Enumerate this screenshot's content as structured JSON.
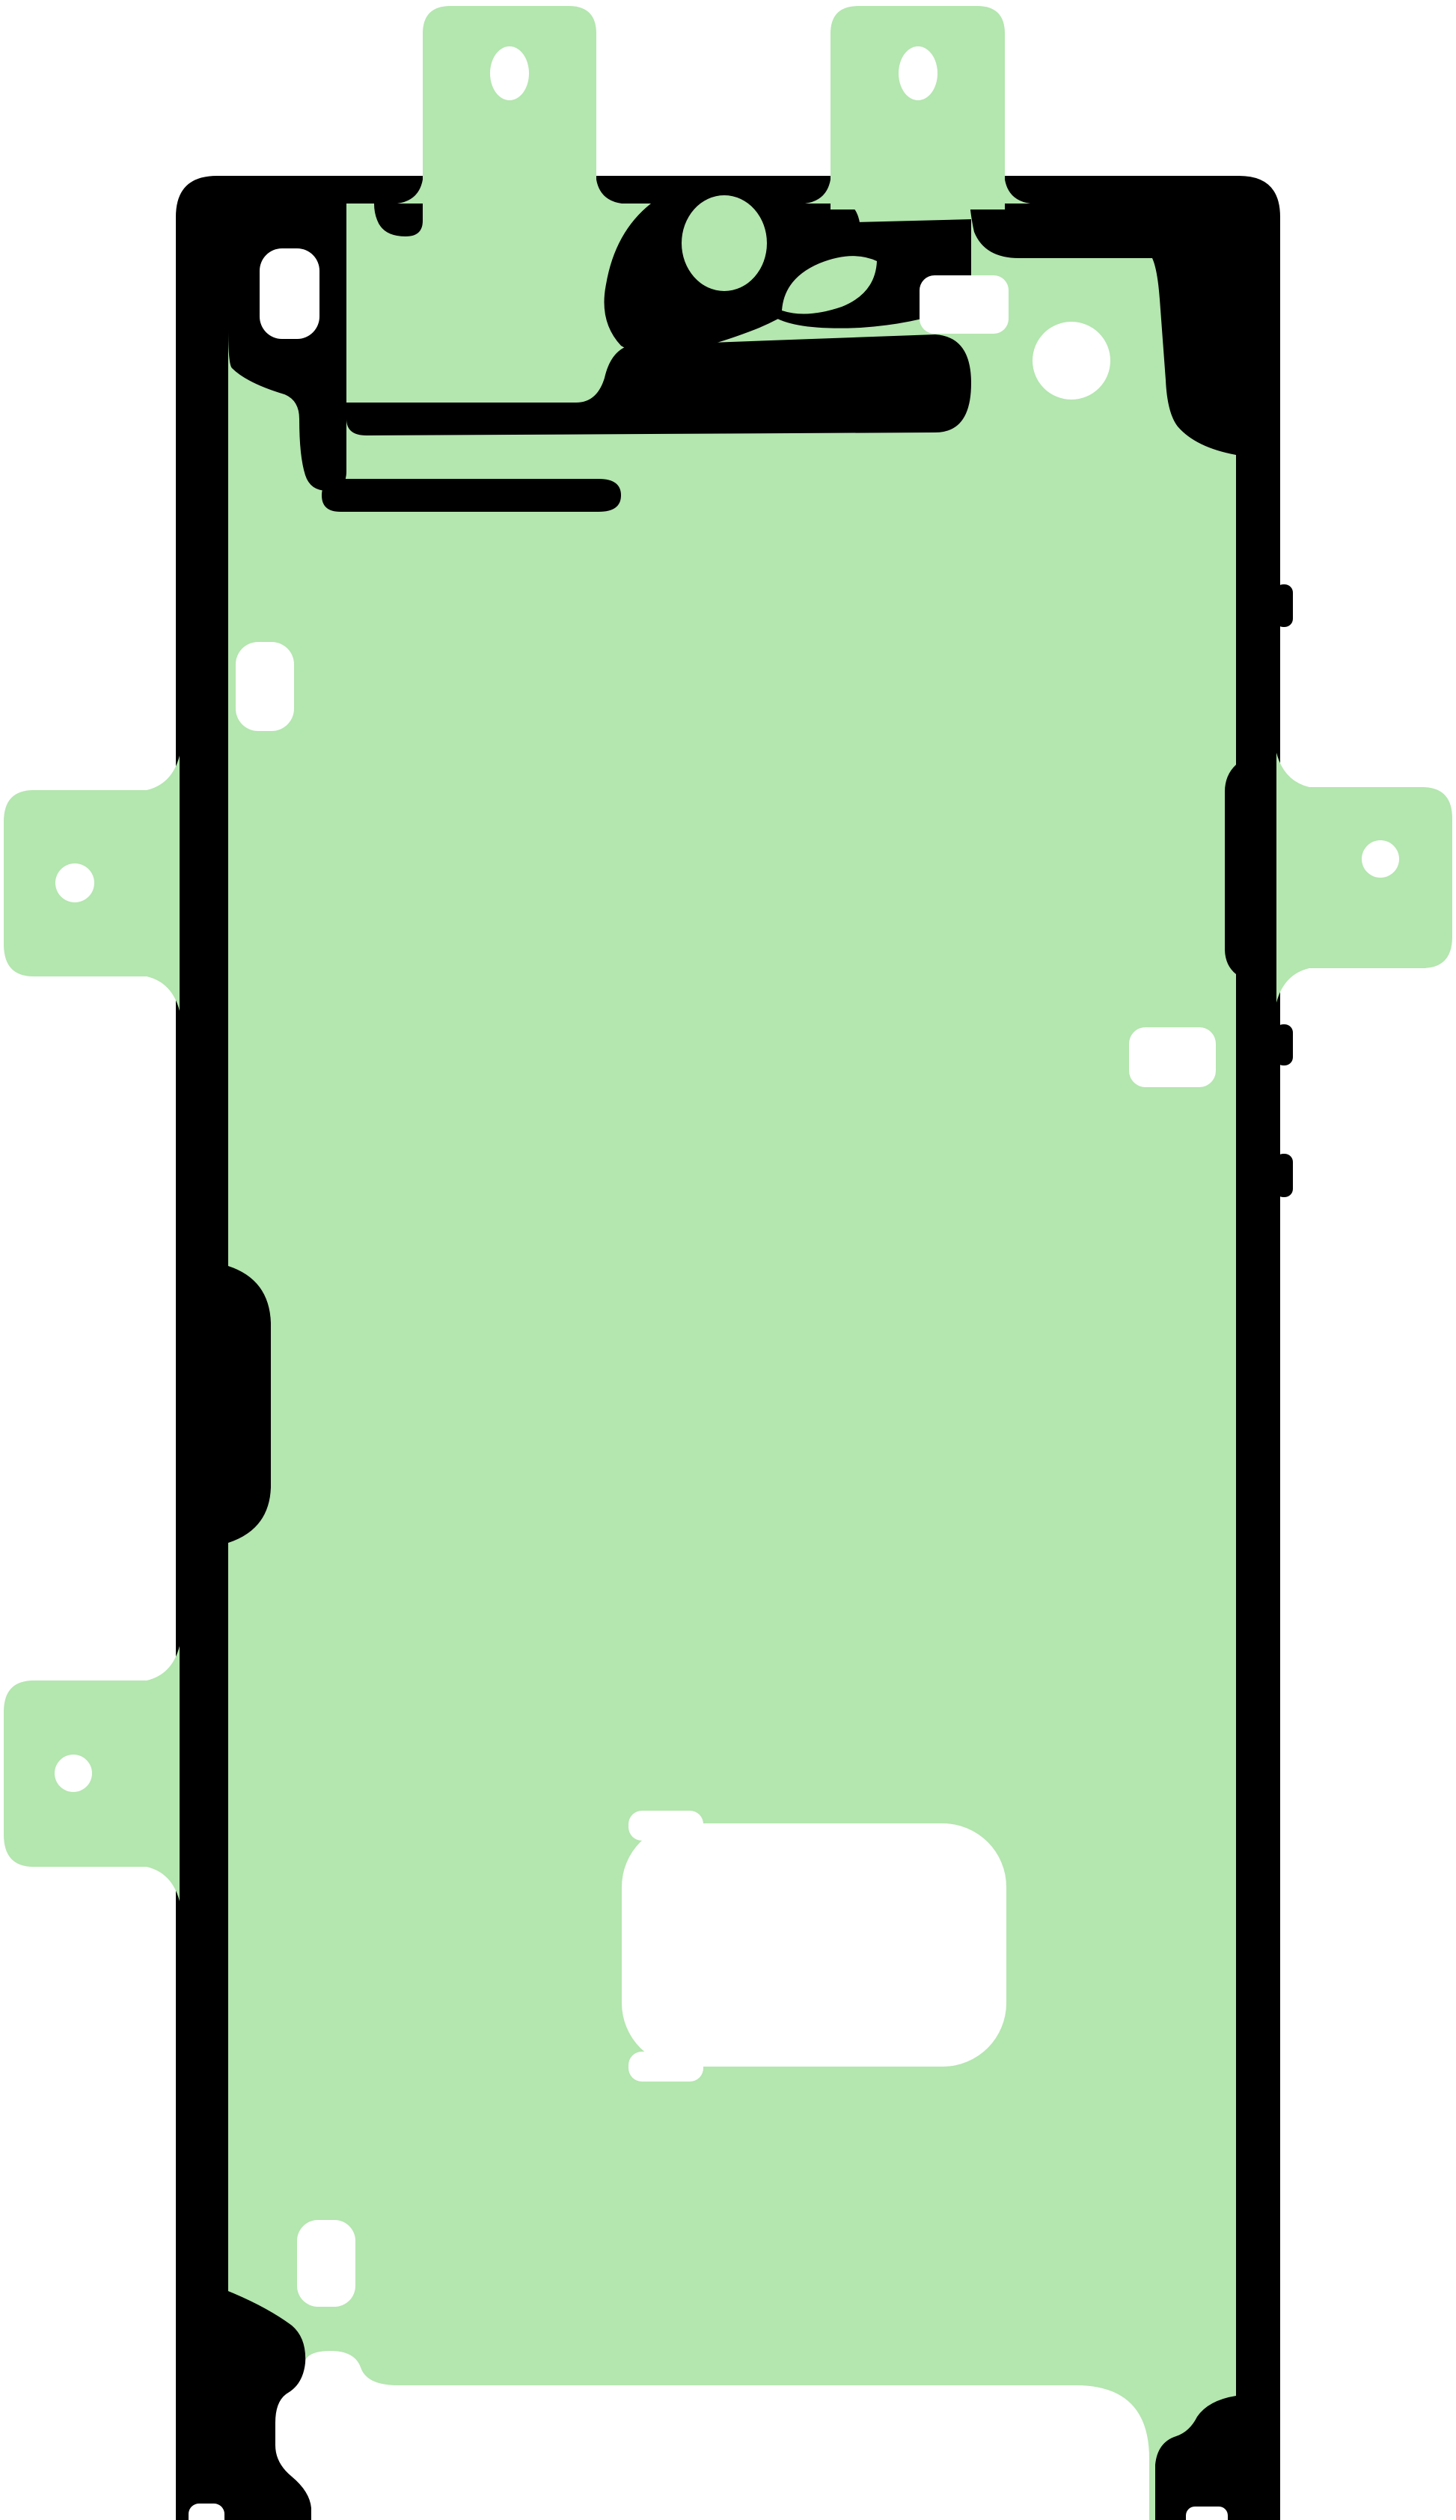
{
  "image": {
    "kind": "product-photo",
    "subject": "smartphone-screen-adhesive-sticker",
    "background": "#ffffff"
  },
  "colors": {
    "adhesive_green": "#b4e6af",
    "outline_black": "#000000",
    "cutout_white": "#ffffff"
  },
  "counts": {
    "top_tabs": "2",
    "side_tabs": "3",
    "tab_holes": "5"
  }
}
